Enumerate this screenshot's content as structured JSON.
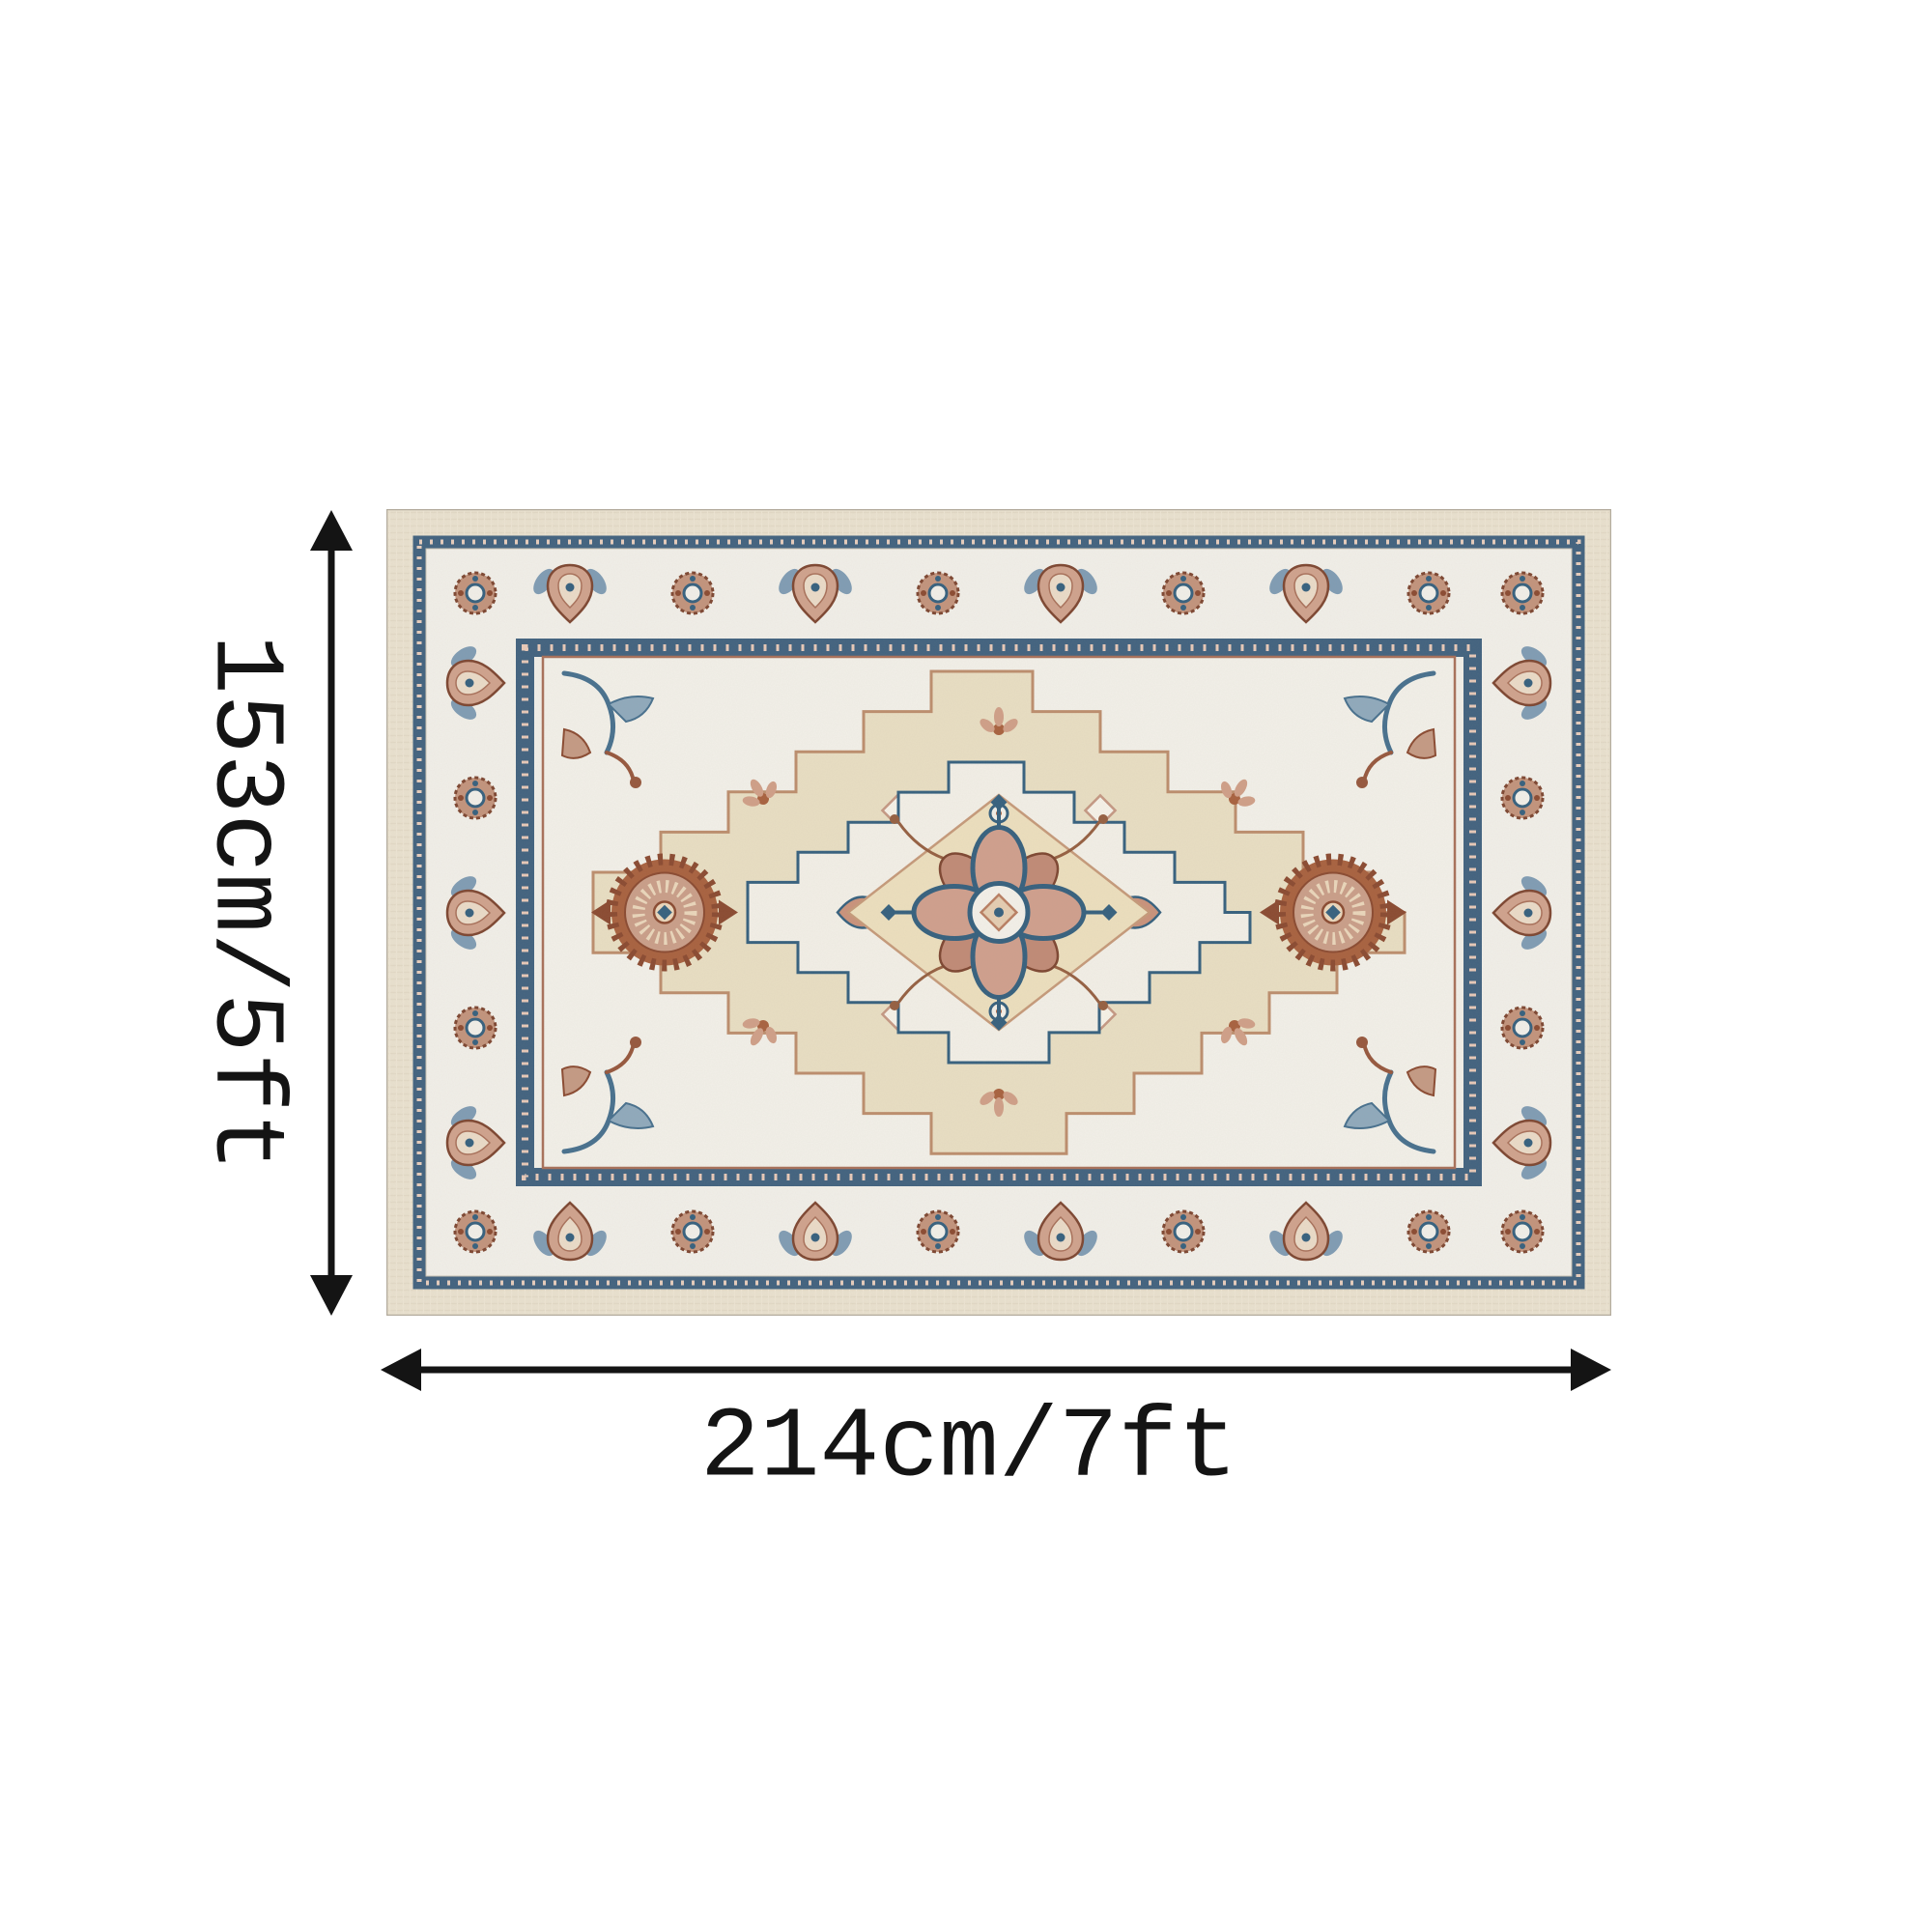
{
  "page": {
    "background": "#ffffff"
  },
  "dimensions": {
    "height_label": "153cm/5ft",
    "width_label": "214cm/7ft"
  },
  "rug": {
    "style": "oriental-medallion-area-rug",
    "palette": {
      "outer_band": "#e9e1cf",
      "border_ground": "#f1efe9",
      "guard_blue": "#41627f",
      "field_ivory": "#f2f0e9",
      "medallion_cream": "#e8dec3",
      "center_cream": "#ecdfbe",
      "terracotta": "#a8613f",
      "clay_pink": "#c99e89",
      "deep_brown": "#8a4a31",
      "steel_blue": "#35607e"
    }
  },
  "annotation": {
    "color": "#141414"
  }
}
